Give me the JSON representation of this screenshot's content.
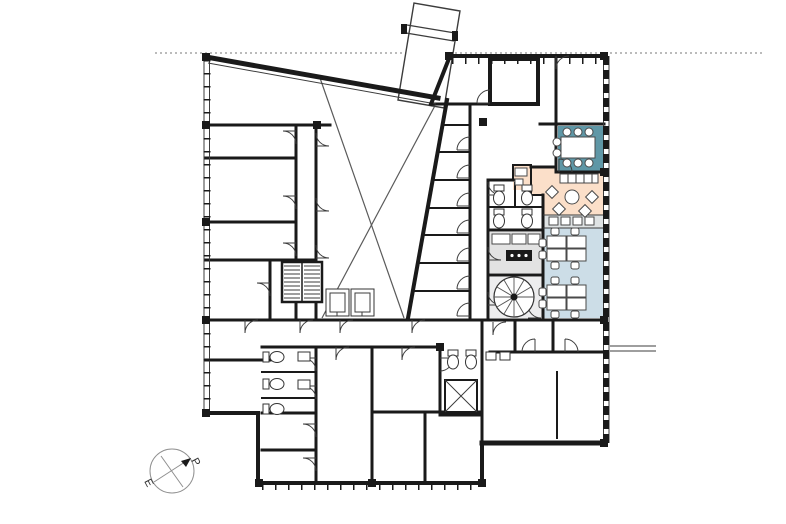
{
  "document": {
    "type": "architectural-floor-plan",
    "description": "Office building floor plan with atrium void, angled entrance walkway, colored meeting/lounge/workspace zones, cores and WC clusters",
    "visible_text_labels": [
      "P",
      "E"
    ]
  },
  "compass": {
    "north_label": "P",
    "south_label": "E"
  },
  "colors": {
    "wall": "#1a1a1a",
    "thin_line": "#3c3c3c",
    "void_line": "#5a5a5a",
    "teal_room": "#5f97a6",
    "lounge_peach": "#fbdfc9",
    "workspace_blue": "#ccdde7",
    "kitchen_gray": "#e2e2e2",
    "spiral_gray": "#ededee",
    "band_gray": "#dfe3e4",
    "paper": "#ffffff",
    "compass_line": "#909090"
  },
  "zones": {
    "meeting_room": {
      "name": "meeting room",
      "tables": 1,
      "chairs": 8
    },
    "lounge": {
      "name": "lounge breakout",
      "round_tables": 1,
      "lounge_chairs": 4,
      "benches": 2
    },
    "open_workspace": {
      "name": "open workspace",
      "desk_clusters": 2,
      "desks_per_cluster": 4
    },
    "kitchen": {
      "name": "kitchenette"
    },
    "cores": {
      "main_stairs": 1,
      "spiral_stairs": 1,
      "elevators": 2,
      "wc_clusters": 3,
      "shafts": 1
    },
    "office_bays_along_atrium": 7
  }
}
